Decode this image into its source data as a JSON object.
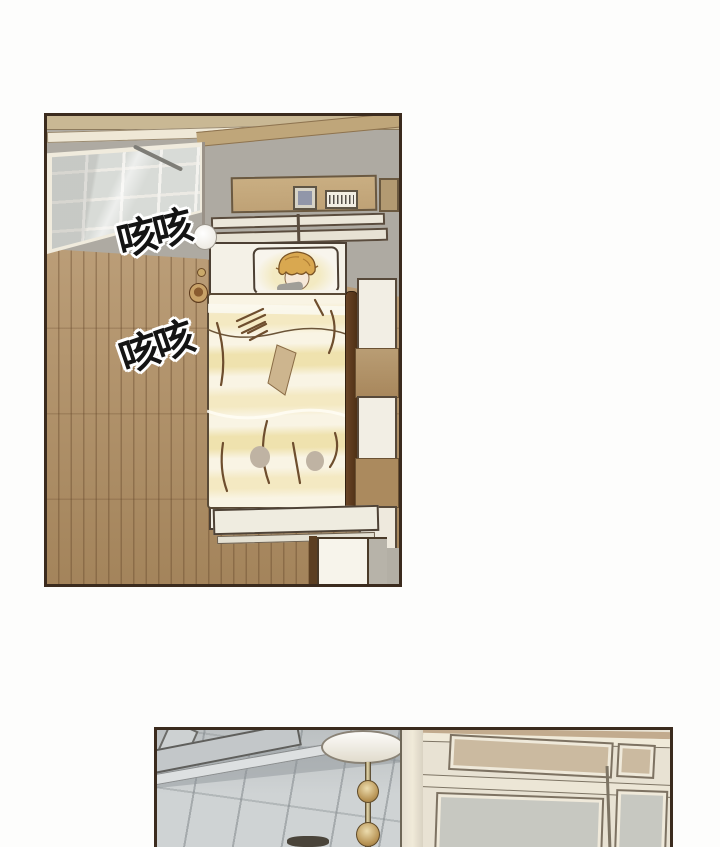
{
  "page": {
    "type": "comic-page",
    "background_color": "#fdfdfc",
    "panel_border_color": "#3b2b1e"
  },
  "sfx": {
    "cough_1": "咳咳",
    "cough_2": "咳咳"
  },
  "palette": {
    "floor_wood": "#b08e62",
    "floor_wood_line": "#60422a",
    "wall_gray": "#aeaaa2",
    "wall_tan_strip": "#c9b894",
    "beam_tan": "#bfa67a",
    "window_glass": "#d8dbd7",
    "window_frame": "#f0ebdd",
    "headboard_shelf": "#c3a87c",
    "photo_frame_picture": "#9196a9",
    "bed_white": "#f4f1e7",
    "pillow": "#f8f5ed",
    "hair_blonde": "#d9a850",
    "skin": "#f6e8d8",
    "blanket_cream": "#f9f4e4",
    "blanket_yellow": "#f0e2ae",
    "blanket_patch_tan": "#cdb58e",
    "blanket_patch_gray": "#bfb3a3",
    "crease_brown": "#6e4e2e",
    "bed_side_rail_dark": "#4e3015",
    "footboard": "#efece0",
    "nightstand": "#f7f4eb",
    "tile_floor": "#cfd3d4",
    "tile_grout": "#82888c",
    "lamp_shade": "#f3efe2",
    "brass_pole": "#b89455",
    "cabinet_cream": "#e8e2d3",
    "cabinet_inset_tan": "#cbbaa0",
    "cabinet_inset_gray": "#c7c8c1"
  }
}
